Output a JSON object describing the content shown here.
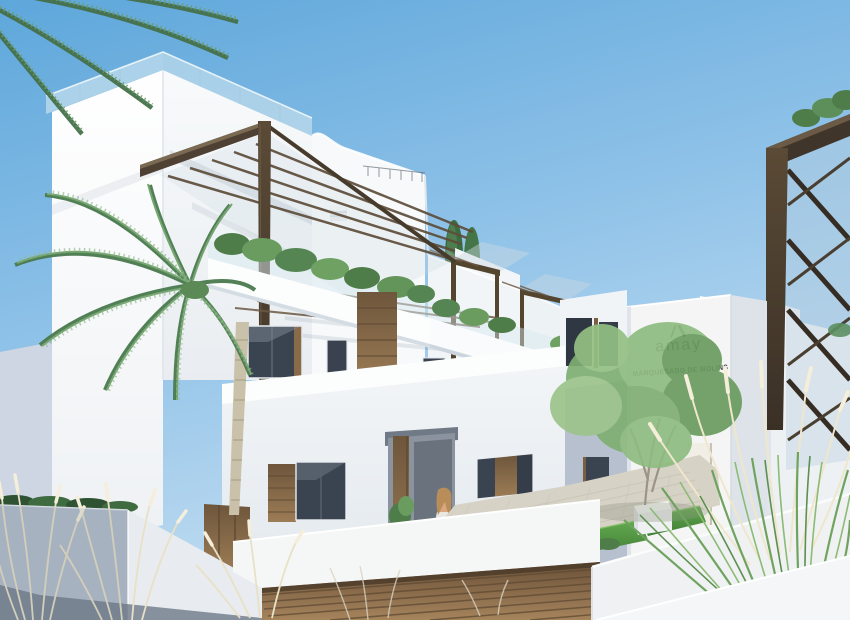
{
  "meta": {
    "type": "architectural-render",
    "description": "Exterior 3D render of a white Mediterranean apartment complex with wooden pergolas, roof terraces, a palm tree, ornamental grasses, a landscaped courtyard with white cube benches, an underground garage ramp with a wooden slat door, and a woman walking toward the entrance."
  },
  "signage": {
    "brand": "amay",
    "project": "MARQUESADO DE MOLINS",
    "logo_mark": "amay-chevron-monogram"
  },
  "palette": {
    "sky_top": "#5ea7db",
    "sky_mid": "#8fc2e8",
    "sky_horizon": "#c6dff2",
    "wall_sunlit": "#fdfdfc",
    "wall_lit": "#f4f6f7",
    "wall_shaded": "#b3bdcb",
    "pergola_wood": "#4e4133",
    "warm_wood": "#9a7850",
    "window_glass": "#3a4350",
    "balustrade_glass": "#d6e9f1",
    "foliage_green": "#6a9b5f",
    "palm_green": "#4f7d50",
    "lawn_green": "#4a8c3f",
    "paving": "#d7d2c6",
    "dry_plume": "#ece4cc",
    "sign_text": "#3f4043"
  },
  "scene": {
    "elements": [
      "clear blue sky",
      "rooftop glass balustrades",
      "dark timber pergola frames with rafters",
      "balcony planters with shrubs",
      "two cypress trees",
      "white tower with amay project signage",
      "courtyard with lawn squares and white bench cubes",
      "green courtyard tree",
      "palm tree and overhanging palm fronds",
      "ornamental pampas grasses",
      "garage ramp with wooden slat door",
      "woman with floral dress and handbag",
      "timber entrance door and window shutters"
    ]
  }
}
